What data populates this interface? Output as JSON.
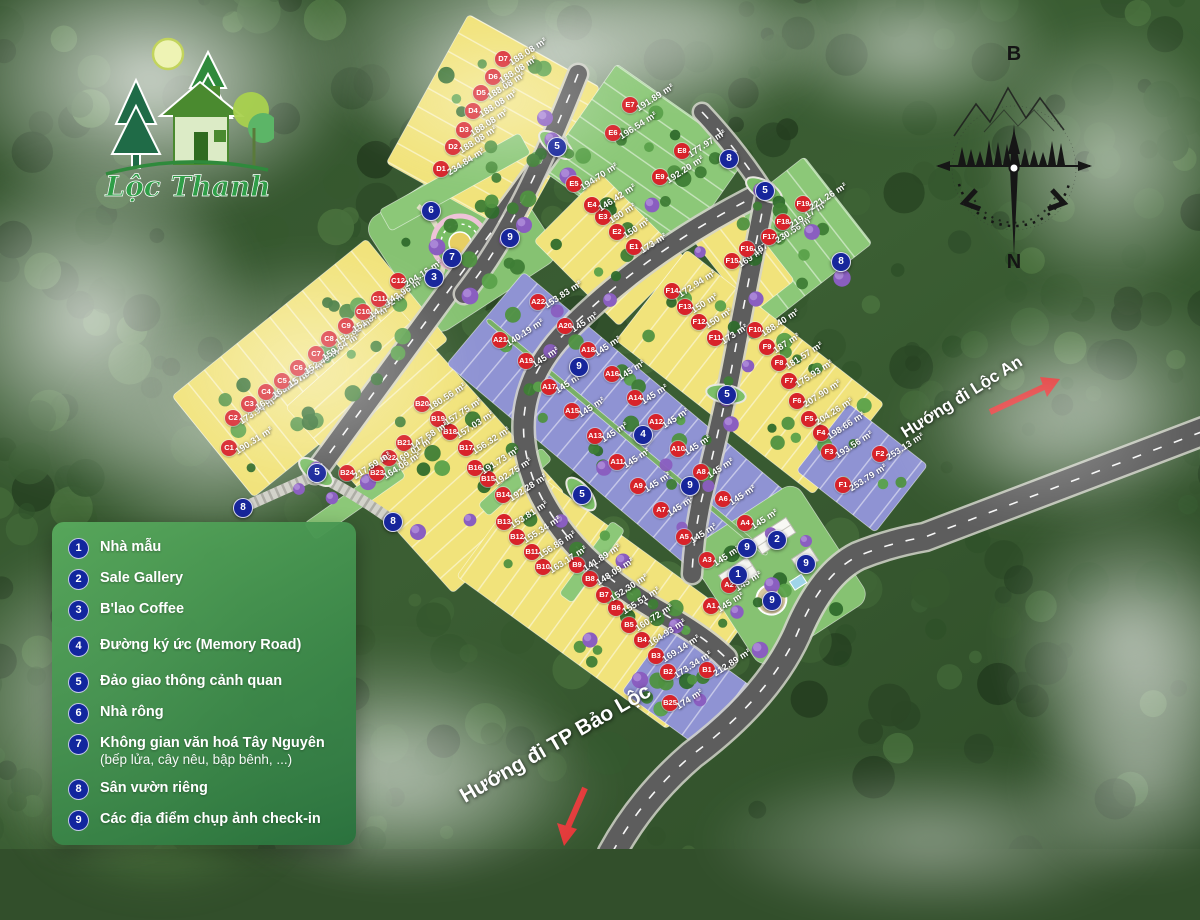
{
  "logo": {
    "name": "Lộc Thanh"
  },
  "compass": {
    "north": "B",
    "south": "N"
  },
  "legend": {
    "items": [
      {
        "num": "1",
        "label": "Nhà mẫu"
      },
      {
        "num": "2",
        "label": "Sale Gallery"
      },
      {
        "num": "3",
        "label": "B'lao Coffee"
      },
      {
        "num": "4",
        "label": "Đường ký ức (Memory Road)"
      },
      {
        "num": "5",
        "label": "Đảo giao thông cảnh quan"
      },
      {
        "num": "6",
        "label": "Nhà rông"
      },
      {
        "num": "7",
        "label": "Không gian văn hoá Tây Nguyên",
        "sub": "(bếp lửa, cây nêu, bập bênh, ...)"
      },
      {
        "num": "8",
        "label": "Sân vườn riêng"
      },
      {
        "num": "9",
        "label": "Các địa điểm chụp ảnh check-in"
      }
    ]
  },
  "directions": [
    {
      "label": "Hướng đi Lộc An"
    },
    {
      "label": "Hướng đi TP Bảo Lộc"
    }
  ],
  "map": {
    "lots": [
      {
        "id": "A1",
        "area": "145 m²",
        "x": 711,
        "y": 606,
        "zone": "purple"
      },
      {
        "id": "A2",
        "area": "145 m²",
        "x": 729,
        "y": 585,
        "zone": "purple"
      },
      {
        "id": "A3",
        "area": "145 m²",
        "x": 707,
        "y": 560,
        "zone": "purple"
      },
      {
        "id": "A4",
        "area": "145 m²",
        "x": 745,
        "y": 523,
        "zone": "purple"
      },
      {
        "id": "A5",
        "area": "145 m²",
        "x": 684,
        "y": 537,
        "zone": "purple"
      },
      {
        "id": "A6",
        "area": "145 m²",
        "x": 723,
        "y": 499,
        "zone": "purple"
      },
      {
        "id": "A7",
        "area": "145 m²",
        "x": 661,
        "y": 510,
        "zone": "purple"
      },
      {
        "id": "A8",
        "area": "145 m²",
        "x": 701,
        "y": 472,
        "zone": "purple"
      },
      {
        "id": "A9",
        "area": "145 m²",
        "x": 638,
        "y": 486,
        "zone": "purple"
      },
      {
        "id": "A10",
        "area": "145 m²",
        "x": 678,
        "y": 449,
        "zone": "purple"
      },
      {
        "id": "A11",
        "area": "145 m²",
        "x": 617,
        "y": 462,
        "zone": "purple"
      },
      {
        "id": "A12",
        "area": "145 m²",
        "x": 656,
        "y": 422,
        "zone": "purple"
      },
      {
        "id": "A13",
        "area": "145 m²",
        "x": 595,
        "y": 436,
        "zone": "purple"
      },
      {
        "id": "A14",
        "area": "145 m²",
        "x": 635,
        "y": 398,
        "zone": "purple"
      },
      {
        "id": "A15",
        "area": "145 m²",
        "x": 572,
        "y": 411,
        "zone": "purple"
      },
      {
        "id": "A16",
        "area": "145 m²",
        "x": 612,
        "y": 374,
        "zone": "purple"
      },
      {
        "id": "A17",
        "area": "145 m²",
        "x": 549,
        "y": 387,
        "zone": "purple"
      },
      {
        "id": "A18",
        "area": "145 m²",
        "x": 588,
        "y": 350,
        "zone": "purple"
      },
      {
        "id": "A19",
        "area": "145 m²",
        "x": 526,
        "y": 361,
        "zone": "purple"
      },
      {
        "id": "A20",
        "area": "145 m²",
        "x": 565,
        "y": 326,
        "zone": "purple"
      },
      {
        "id": "A21",
        "area": "140.19 m²",
        "x": 500,
        "y": 340,
        "zone": "purple"
      },
      {
        "id": "A22",
        "area": "153.83 m²",
        "x": 538,
        "y": 302,
        "zone": "purple"
      },
      {
        "id": "B1",
        "area": "212.89 m²",
        "x": 707,
        "y": 670,
        "zone": "purple"
      },
      {
        "id": "B2",
        "area": "173.34 m²",
        "x": 668,
        "y": 672,
        "zone": "yellow"
      },
      {
        "id": "B3",
        "area": "169.14 m²",
        "x": 656,
        "y": 656,
        "zone": "yellow"
      },
      {
        "id": "B4",
        "area": "164.93 m²",
        "x": 642,
        "y": 640,
        "zone": "yellow"
      },
      {
        "id": "B5",
        "area": "160.72 m²",
        "x": 629,
        "y": 625,
        "zone": "yellow"
      },
      {
        "id": "B6",
        "area": "155.51 m²",
        "x": 616,
        "y": 608,
        "zone": "yellow"
      },
      {
        "id": "B7",
        "area": "152.30 m²",
        "x": 604,
        "y": 595,
        "zone": "yellow"
      },
      {
        "id": "B8",
        "area": "148.09 m²",
        "x": 590,
        "y": 579,
        "zone": "yellow"
      },
      {
        "id": "B9",
        "area": "141.89 m²",
        "x": 577,
        "y": 565,
        "zone": "green"
      },
      {
        "id": "B10",
        "area": "163.17 m²",
        "x": 543,
        "y": 567,
        "zone": "yellow"
      },
      {
        "id": "B11",
        "area": "156.86 m²",
        "x": 532,
        "y": 552,
        "zone": "yellow"
      },
      {
        "id": "B12",
        "area": "155.34 m²",
        "x": 517,
        "y": 537,
        "zone": "yellow"
      },
      {
        "id": "B13",
        "area": "153.81 m²",
        "x": 504,
        "y": 522,
        "zone": "yellow"
      },
      {
        "id": "B14",
        "area": "192.28 m²",
        "x": 503,
        "y": 495,
        "zone": "green"
      },
      {
        "id": "B15",
        "area": "192.75 m²",
        "x": 488,
        "y": 479,
        "zone": "yellow"
      },
      {
        "id": "B16",
        "area": "191.73 m²",
        "x": 475,
        "y": 468,
        "zone": "yellow"
      },
      {
        "id": "B17",
        "area": "156.32 m²",
        "x": 466,
        "y": 448,
        "zone": "yellow"
      },
      {
        "id": "B18",
        "area": "157.03 m²",
        "x": 450,
        "y": 432,
        "zone": "yellow"
      },
      {
        "id": "B19",
        "area": "157.75 m²",
        "x": 438,
        "y": 419,
        "zone": "yellow"
      },
      {
        "id": "B20",
        "area": "180.56 m²",
        "x": 422,
        "y": 404,
        "zone": "yellow"
      },
      {
        "id": "B21",
        "area": "147.58 m²",
        "x": 404,
        "y": 443,
        "zone": "yellow"
      },
      {
        "id": "B22",
        "area": "169.01 m²",
        "x": 389,
        "y": 458,
        "zone": "yellow"
      },
      {
        "id": "B23",
        "area": "164.06 m²",
        "x": 377,
        "y": 473,
        "zone": "yellow"
      },
      {
        "id": "B24",
        "area": "217.59 m²",
        "x": 347,
        "y": 473,
        "zone": "green"
      },
      {
        "id": "B25",
        "area": "174 m²",
        "x": 670,
        "y": 703,
        "zone": "purple"
      },
      {
        "id": "C1",
        "area": "190.31 m²",
        "x": 229,
        "y": 448,
        "zone": "yellow"
      },
      {
        "id": "C2",
        "area": "173.94 m²",
        "x": 233,
        "y": 418,
        "zone": "yellow"
      },
      {
        "id": "C3",
        "area": "168.58 m²",
        "x": 249,
        "y": 404,
        "zone": "yellow"
      },
      {
        "id": "C4",
        "area": "163.22 m²",
        "x": 266,
        "y": 392,
        "zone": "yellow"
      },
      {
        "id": "C5",
        "area": "157.85 m²",
        "x": 282,
        "y": 381,
        "zone": "yellow"
      },
      {
        "id": "C6",
        "area": "152.49 m²",
        "x": 298,
        "y": 368,
        "zone": "yellow"
      },
      {
        "id": "C7",
        "area": "159.84 m²",
        "x": 316,
        "y": 354,
        "zone": "yellow"
      },
      {
        "id": "C8",
        "area": "155.82 m²",
        "x": 329,
        "y": 339,
        "zone": "yellow"
      },
      {
        "id": "C9",
        "area": "151.87 m²",
        "x": 346,
        "y": 326,
        "zone": "yellow"
      },
      {
        "id": "C10",
        "area": "147.92 m²",
        "x": 363,
        "y": 312,
        "zone": "yellow"
      },
      {
        "id": "C11",
        "area": "143.96 m²",
        "x": 379,
        "y": 299,
        "zone": "yellow"
      },
      {
        "id": "C12",
        "area": "204.16 m²",
        "x": 398,
        "y": 281,
        "zone": "yellow"
      },
      {
        "id": "D1",
        "area": "234.84 m²",
        "x": 441,
        "y": 169,
        "zone": "green"
      },
      {
        "id": "D2",
        "area": "188.08 m²",
        "x": 453,
        "y": 147,
        "zone": "yellow"
      },
      {
        "id": "D3",
        "area": "188.08 m²",
        "x": 464,
        "y": 130,
        "zone": "yellow"
      },
      {
        "id": "D4",
        "area": "188.08 m²",
        "x": 473,
        "y": 111,
        "zone": "yellow"
      },
      {
        "id": "D5",
        "area": "188.08 m²",
        "x": 481,
        "y": 93,
        "zone": "yellow"
      },
      {
        "id": "D6",
        "area": "188.08 m²",
        "x": 493,
        "y": 77,
        "zone": "yellow"
      },
      {
        "id": "D7",
        "area": "188.08 m²",
        "x": 503,
        "y": 59,
        "zone": "yellow"
      },
      {
        "id": "E1",
        "area": "173 m²",
        "x": 634,
        "y": 247,
        "zone": "yellow"
      },
      {
        "id": "E2",
        "area": "150 m²",
        "x": 617,
        "y": 232,
        "zone": "yellow"
      },
      {
        "id": "E3",
        "area": "150 m²",
        "x": 603,
        "y": 217,
        "zone": "yellow"
      },
      {
        "id": "E4",
        "area": "146.42 m²",
        "x": 592,
        "y": 205,
        "zone": "yellow"
      },
      {
        "id": "E5",
        "area": "194.70 m²",
        "x": 574,
        "y": 184,
        "zone": "green"
      },
      {
        "id": "E6",
        "area": "196.54 m²",
        "x": 613,
        "y": 133,
        "zone": "green"
      },
      {
        "id": "E7",
        "area": "191.89 m²",
        "x": 630,
        "y": 105,
        "zone": "green"
      },
      {
        "id": "E8",
        "area": "177.97 m²",
        "x": 682,
        "y": 151,
        "zone": "green"
      },
      {
        "id": "E9",
        "area": "192.20 m²",
        "x": 660,
        "y": 177,
        "zone": "green"
      },
      {
        "id": "F1",
        "area": "253.79 m²",
        "x": 843,
        "y": 485,
        "zone": "purple"
      },
      {
        "id": "F2",
        "area": "253.13 m²",
        "x": 880,
        "y": 454,
        "zone": "purple"
      },
      {
        "id": "F3",
        "area": "193.56 m²",
        "x": 829,
        "y": 452,
        "zone": "yellow"
      },
      {
        "id": "F4",
        "area": "198.66 m²",
        "x": 821,
        "y": 433,
        "zone": "yellow"
      },
      {
        "id": "F5",
        "area": "204.26 m²",
        "x": 809,
        "y": 419,
        "zone": "yellow"
      },
      {
        "id": "F6",
        "area": "207.90 m²",
        "x": 797,
        "y": 401,
        "zone": "yellow"
      },
      {
        "id": "F7",
        "area": "175.93 m²",
        "x": 789,
        "y": 381,
        "zone": "yellow"
      },
      {
        "id": "F8",
        "area": "181.57 m²",
        "x": 779,
        "y": 363,
        "zone": "yellow"
      },
      {
        "id": "F9",
        "area": "187 m²",
        "x": 767,
        "y": 347,
        "zone": "yellow"
      },
      {
        "id": "F10",
        "area": "188.40 m²",
        "x": 755,
        "y": 330,
        "zone": "yellow"
      },
      {
        "id": "F11",
        "area": "173 m²",
        "x": 715,
        "y": 338,
        "zone": "green"
      },
      {
        "id": "F12",
        "area": "150 m²",
        "x": 699,
        "y": 322,
        "zone": "yellow"
      },
      {
        "id": "F13",
        "area": "150 m²",
        "x": 685,
        "y": 307,
        "zone": "yellow"
      },
      {
        "id": "F14",
        "area": "172.94 m²",
        "x": 672,
        "y": 291,
        "zone": "yellow"
      },
      {
        "id": "F15",
        "area": "169 m²",
        "x": 732,
        "y": 261,
        "zone": "yellow"
      },
      {
        "id": "F16",
        "area": "167 m²",
        "x": 747,
        "y": 249,
        "zone": "yellow"
      },
      {
        "id": "F17",
        "area": "230.56 m²",
        "x": 769,
        "y": 237,
        "zone": "green"
      },
      {
        "id": "F18",
        "area": "219.17 m²",
        "x": 783,
        "y": 222,
        "zone": "green"
      },
      {
        "id": "F19",
        "area": "221.26 m²",
        "x": 803,
        "y": 204,
        "zone": "green"
      }
    ],
    "markers": [
      {
        "num": "6",
        "x": 430,
        "y": 210
      },
      {
        "num": "9",
        "x": 509,
        "y": 237
      },
      {
        "num": "7",
        "x": 451,
        "y": 257
      },
      {
        "num": "3",
        "x": 433,
        "y": 277
      },
      {
        "num": "5",
        "x": 556,
        "y": 146
      },
      {
        "num": "8",
        "x": 728,
        "y": 158
      },
      {
        "num": "5",
        "x": 764,
        "y": 190
      },
      {
        "num": "8",
        "x": 840,
        "y": 261
      },
      {
        "num": "5",
        "x": 726,
        "y": 394
      },
      {
        "num": "9",
        "x": 578,
        "y": 366
      },
      {
        "num": "4",
        "x": 642,
        "y": 434
      },
      {
        "num": "5",
        "x": 316,
        "y": 472
      },
      {
        "num": "8",
        "x": 242,
        "y": 507
      },
      {
        "num": "8",
        "x": 392,
        "y": 521
      },
      {
        "num": "5",
        "x": 581,
        "y": 494
      },
      {
        "num": "9",
        "x": 689,
        "y": 485
      },
      {
        "num": "9",
        "x": 746,
        "y": 547
      },
      {
        "num": "2",
        "x": 776,
        "y": 539
      },
      {
        "num": "1",
        "x": 737,
        "y": 574
      },
      {
        "num": "9",
        "x": 805,
        "y": 563
      },
      {
        "num": "9",
        "x": 771,
        "y": 600
      }
    ]
  },
  "colors": {
    "badge_red": "#d8232a",
    "marker_blue": "#17269b",
    "lot_yellow": "#f1e37b",
    "lot_green": "#8cc878",
    "lot_purple": "#8f93d3",
    "road_gray": "#5d5d5d",
    "legend_green_from": "#58a95c",
    "legend_green_to": "#28713c",
    "arrow_red": "#e23333"
  }
}
